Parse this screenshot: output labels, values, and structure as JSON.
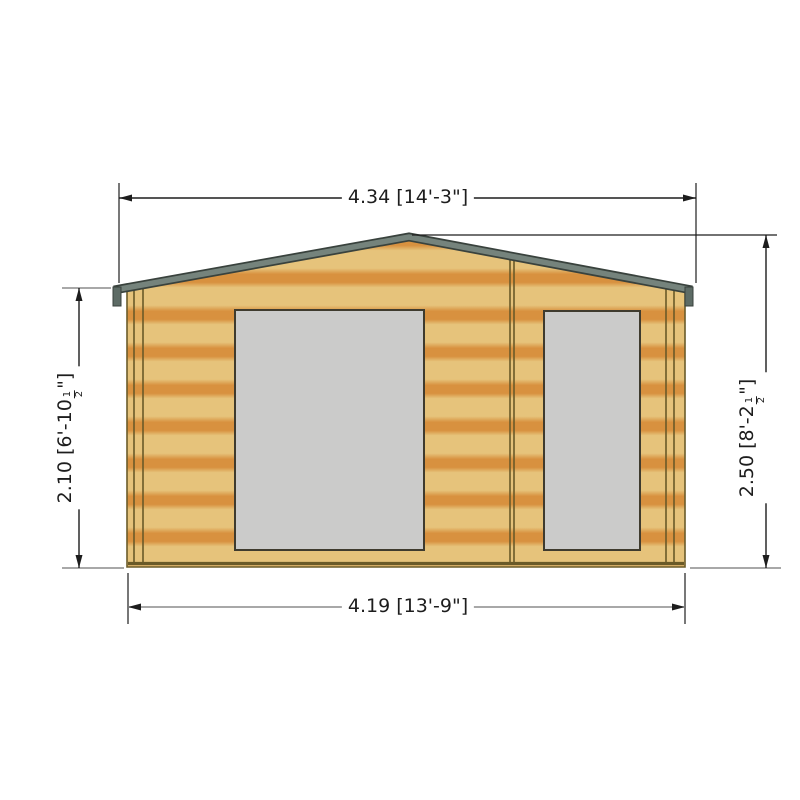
{
  "drawing_title": "log-cabin-front-elevation",
  "colors": {
    "wood_light": "#e6c37b",
    "wood_dark": "#d8913f",
    "roof_gray": "#75837c",
    "roof_edge": "#39423d",
    "roof_tab": "#5d6b65",
    "window_gray": "#cbcbca",
    "line_dark": "#3f3b2e",
    "line_mid": "#6a5a28",
    "wall_outline": "#6b5c2a",
    "dim_black": "#1d1d1d",
    "dim_gray": "#8c8c8c"
  },
  "dimensions": {
    "top": {
      "label": "4.34 [14'-3\"]"
    },
    "bottom": {
      "label": "4.19 [13'-9\"]"
    },
    "left": {
      "prefix": "2.10 [6'-10",
      "frac_num": "1",
      "frac_den": "2",
      "suffix": "\"]"
    },
    "right": {
      "prefix": "2.50 [8'-2",
      "frac_num": "1",
      "frac_den": "2",
      "suffix": "\"]"
    }
  }
}
